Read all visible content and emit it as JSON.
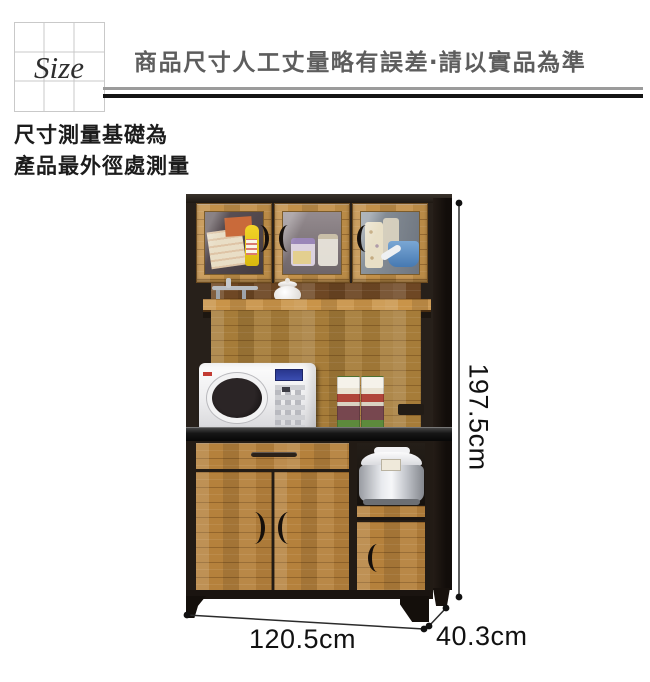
{
  "header": {
    "size_label": "Size",
    "disclaimer": "商品尺寸人工丈量略有誤差‧請以實品為準"
  },
  "note": {
    "line1": "尺寸測量基礎為",
    "line2": "產品最外徑處測量"
  },
  "dimensions": {
    "height": "197.5cm",
    "width": "120.5cm",
    "depth": "40.3cm"
  },
  "colors": {
    "wood": "#b5813c",
    "frame_dark": "#241d18",
    "counter_black": "#121212",
    "rule_gray": "#9b9b9b",
    "rule_black": "#141414",
    "header_text": "#5d5d5d"
  }
}
